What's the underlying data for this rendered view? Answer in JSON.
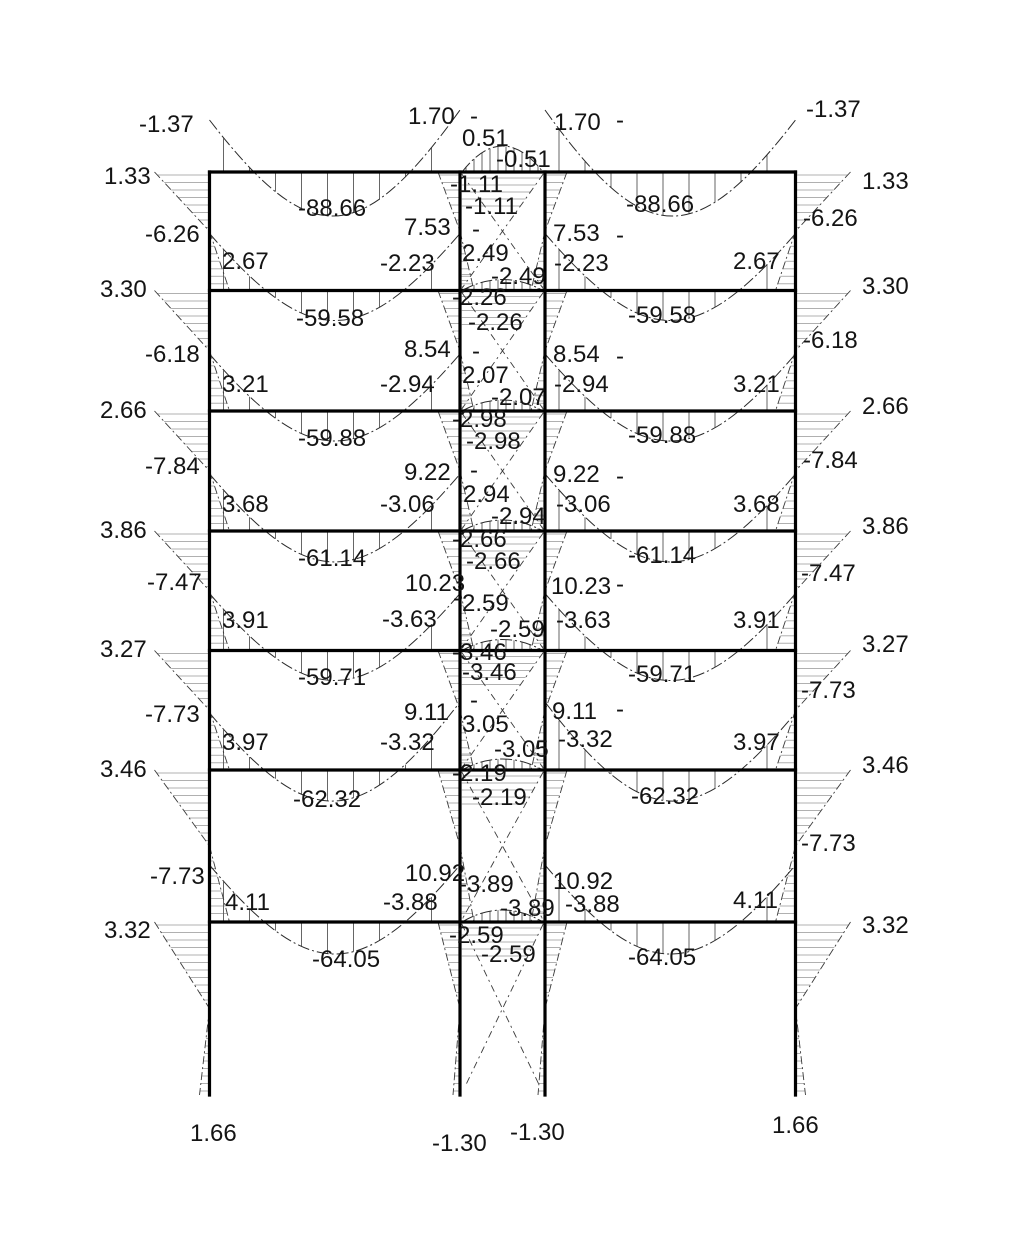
{
  "canvas": {
    "width": 1010,
    "height": 1256,
    "background": "#ffffff",
    "ink": "#141414",
    "frame_color": "#000000",
    "curve_color": "#2a2a2a",
    "beam_hatch_color": "#555555",
    "column_hatch_color": "#b0b0b0"
  },
  "frame": {
    "columns_x": [
      209.5,
      460,
      545,
      795.5
    ],
    "floors_y": [
      172,
      290.5,
      411,
      531,
      650.5,
      770,
      922
    ],
    "base_y": 1095,
    "bays": [
      [
        209.5,
        460
      ],
      [
        545,
        795.5
      ]
    ],
    "corridor": [
      460,
      545
    ]
  },
  "moment_curves": {
    "beam_mid_values": [
      -88.66,
      -59.58,
      -59.88,
      -61.14,
      -59.71,
      -62.32,
      -64.05
    ],
    "mid_dip_px": [
      44,
      30,
      30,
      31,
      30,
      31,
      32
    ],
    "end_height_exterior_px": [
      52,
      57,
      57,
      57,
      57,
      57,
      57
    ],
    "end_height_interior_px": [
      62,
      57,
      57,
      57,
      57,
      68,
      57
    ],
    "corridor_arc_px": [
      26,
      11,
      11,
      11,
      11,
      11,
      12
    ],
    "beam_hatch_step": 26,
    "corridor_hatch_step": 8
  },
  "column_wedges": {
    "exterior_outer_w": 55,
    "exterior_inner_w": 20,
    "exterior_base_w": 10,
    "interior_outer_w": 22,
    "interior_inner_w": 14,
    "interior_base_w": 7,
    "hatch_step": 7.5
  },
  "labels": [
    {
      "t": "-1.37",
      "x": 139,
      "y": 132
    },
    {
      "t": "1.70",
      "x": 408,
      "y": 124
    },
    {
      "t": "-",
      "x": 470,
      "y": 124
    },
    {
      "t": "0.51",
      "x": 462,
      "y": 146
    },
    {
      "t": "-0.51",
      "x": 496,
      "y": 167
    },
    {
      "t": "1.70",
      "x": 554,
      "y": 130
    },
    {
      "t": "-",
      "x": 616,
      "y": 128
    },
    {
      "t": "-1.37",
      "x": 806,
      "y": 117
    },
    {
      "t": "1.33",
      "x": 104,
      "y": 184
    },
    {
      "t": "-88.66",
      "x": 298,
      "y": 216
    },
    {
      "t": "-88.66",
      "x": 626,
      "y": 212
    },
    {
      "t": "1.33",
      "x": 862,
      "y": 189
    },
    {
      "t": "-1.11",
      "x": 450,
      "y": 192
    },
    {
      "t": "-1.11",
      "x": 465,
      "y": 214
    },
    {
      "t": "-6.26",
      "x": 145,
      "y": 242
    },
    {
      "t": "7.53",
      "x": 404,
      "y": 235
    },
    {
      "t": "-",
      "x": 472,
      "y": 237
    },
    {
      "t": "2.49",
      "x": 462,
      "y": 261
    },
    {
      "t": "7.53",
      "x": 553,
      "y": 241
    },
    {
      "t": "-",
      "x": 616,
      "y": 243
    },
    {
      "t": "2.67",
      "x": 222,
      "y": 269
    },
    {
      "t": "-2.23",
      "x": 380,
      "y": 271
    },
    {
      "t": "-2.49",
      "x": 491,
      "y": 284
    },
    {
      "t": "-2.23",
      "x": 554,
      "y": 271
    },
    {
      "t": "2.67",
      "x": 733,
      "y": 269
    },
    {
      "t": "-6.26",
      "x": 803,
      "y": 226
    },
    {
      "t": "3.30",
      "x": 100,
      "y": 297
    },
    {
      "t": "3.30",
      "x": 862,
      "y": 294
    },
    {
      "t": "-2.26",
      "x": 452,
      "y": 305
    },
    {
      "t": "-2.26",
      "x": 468,
      "y": 330
    },
    {
      "t": "-59.58",
      "x": 296,
      "y": 326
    },
    {
      "t": "-59.58",
      "x": 628,
      "y": 323
    },
    {
      "t": "-6.18",
      "x": 145,
      "y": 362
    },
    {
      "t": "8.54",
      "x": 404,
      "y": 357
    },
    {
      "t": "-",
      "x": 472,
      "y": 359
    },
    {
      "t": "2.07",
      "x": 462,
      "y": 383
    },
    {
      "t": "8.54",
      "x": 553,
      "y": 362
    },
    {
      "t": "-",
      "x": 616,
      "y": 364
    },
    {
      "t": "3.21",
      "x": 222,
      "y": 392
    },
    {
      "t": "-2.94",
      "x": 380,
      "y": 392
    },
    {
      "t": "-2.07",
      "x": 491,
      "y": 405
    },
    {
      "t": "-2.94",
      "x": 554,
      "y": 392
    },
    {
      "t": "3.21",
      "x": 733,
      "y": 392
    },
    {
      "t": "-6.18",
      "x": 803,
      "y": 348
    },
    {
      "t": "2.66",
      "x": 100,
      "y": 418
    },
    {
      "t": "2.66",
      "x": 862,
      "y": 414
    },
    {
      "t": "-2.98",
      "x": 452,
      "y": 427
    },
    {
      "t": "-2.98",
      "x": 466,
      "y": 449
    },
    {
      "t": "-59.88",
      "x": 298,
      "y": 446
    },
    {
      "t": "-59.88",
      "x": 628,
      "y": 443
    },
    {
      "t": "-7.84",
      "x": 145,
      "y": 474
    },
    {
      "t": "9.22",
      "x": 404,
      "y": 480
    },
    {
      "t": "-",
      "x": 470,
      "y": 478
    },
    {
      "t": "2.94",
      "x": 463,
      "y": 502
    },
    {
      "t": "9.22",
      "x": 553,
      "y": 482
    },
    {
      "t": "-",
      "x": 616,
      "y": 484
    },
    {
      "t": "3.68",
      "x": 222,
      "y": 512
    },
    {
      "t": "-3.06",
      "x": 380,
      "y": 512
    },
    {
      "t": "-2.94",
      "x": 491,
      "y": 524
    },
    {
      "t": "-3.06",
      "x": 556,
      "y": 512
    },
    {
      "t": "3.68",
      "x": 733,
      "y": 512
    },
    {
      "t": "-7.84",
      "x": 803,
      "y": 468
    },
    {
      "t": "3.86",
      "x": 100,
      "y": 538
    },
    {
      "t": "3.86",
      "x": 862,
      "y": 534
    },
    {
      "t": "-2.66",
      "x": 452,
      "y": 547
    },
    {
      "t": "-2.66",
      "x": 466,
      "y": 569
    },
    {
      "t": "-61.14",
      "x": 298,
      "y": 566
    },
    {
      "t": "-61.14",
      "x": 628,
      "y": 563
    },
    {
      "t": "-7.47",
      "x": 147,
      "y": 590
    },
    {
      "t": "10.23",
      "x": 405,
      "y": 591
    },
    {
      "t": "-",
      "x": 453,
      "y": 606
    },
    {
      "t": "2.59",
      "x": 462,
      "y": 611
    },
    {
      "t": "10.23",
      "x": 551,
      "y": 594
    },
    {
      "t": "-",
      "x": 616,
      "y": 592
    },
    {
      "t": "3.91",
      "x": 222,
      "y": 628
    },
    {
      "t": "-3.63",
      "x": 382,
      "y": 627
    },
    {
      "t": "-2.59",
      "x": 490,
      "y": 637
    },
    {
      "t": "-3.63",
      "x": 556,
      "y": 628
    },
    {
      "t": "3.91",
      "x": 733,
      "y": 628
    },
    {
      "t": "-7.47",
      "x": 801,
      "y": 581
    },
    {
      "t": "3.27",
      "x": 100,
      "y": 657
    },
    {
      "t": "3.27",
      "x": 862,
      "y": 652
    },
    {
      "t": "-3.46",
      "x": 452,
      "y": 660
    },
    {
      "t": "-3.46",
      "x": 462,
      "y": 680
    },
    {
      "t": "-59.71",
      "x": 298,
      "y": 685
    },
    {
      "t": "-59.71",
      "x": 628,
      "y": 682
    },
    {
      "t": "-7.73",
      "x": 145,
      "y": 722
    },
    {
      "t": "9.11",
      "x": 404,
      "y": 720
    },
    {
      "t": "-",
      "x": 470,
      "y": 708
    },
    {
      "t": "3.05",
      "x": 462,
      "y": 732
    },
    {
      "t": "9.11",
      "x": 552,
      "y": 719
    },
    {
      "t": "-",
      "x": 616,
      "y": 717
    },
    {
      "t": "3.97",
      "x": 222,
      "y": 750
    },
    {
      "t": "-3.32",
      "x": 380,
      "y": 750
    },
    {
      "t": "-3.05",
      "x": 494,
      "y": 757
    },
    {
      "t": "-3.32",
      "x": 558,
      "y": 747
    },
    {
      "t": "3.97",
      "x": 733,
      "y": 750
    },
    {
      "t": "-7.73",
      "x": 801,
      "y": 698
    },
    {
      "t": "3.46",
      "x": 100,
      "y": 777
    },
    {
      "t": "3.46",
      "x": 862,
      "y": 773
    },
    {
      "t": "-2.19",
      "x": 452,
      "y": 781
    },
    {
      "t": "-2.19",
      "x": 472,
      "y": 805
    },
    {
      "t": "-62.32",
      "x": 293,
      "y": 807
    },
    {
      "t": "-62.32",
      "x": 631,
      "y": 804
    },
    {
      "t": "-7.73",
      "x": 150,
      "y": 884
    },
    {
      "t": "10.92",
      "x": 405,
      "y": 881
    },
    {
      "t": "10.92",
      "x": 553,
      "y": 889
    },
    {
      "t": "-3.89",
      "x": 459,
      "y": 892
    },
    {
      "t": "-3.89",
      "x": 500,
      "y": 916
    },
    {
      "t": "4.11",
      "x": 225,
      "y": 910
    },
    {
      "t": "-3.88",
      "x": 383,
      "y": 910
    },
    {
      "t": "-3.88",
      "x": 565,
      "y": 912
    },
    {
      "t": "4.11",
      "x": 733,
      "y": 908
    },
    {
      "t": "-7.73",
      "x": 801,
      "y": 851
    },
    {
      "t": "3.32",
      "x": 104,
      "y": 938
    },
    {
      "t": "3.32",
      "x": 862,
      "y": 933
    },
    {
      "t": "-2.59",
      "x": 449,
      "y": 943
    },
    {
      "t": "-2.59",
      "x": 481,
      "y": 962
    },
    {
      "t": "-64.05",
      "x": 312,
      "y": 967
    },
    {
      "t": "-64.05",
      "x": 628,
      "y": 965
    },
    {
      "t": "1.66",
      "x": 190,
      "y": 1141
    },
    {
      "t": "-1.30",
      "x": 432,
      "y": 1151
    },
    {
      "t": "-1.30",
      "x": 510,
      "y": 1140
    },
    {
      "t": "1.66",
      "x": 772,
      "y": 1133
    }
  ]
}
